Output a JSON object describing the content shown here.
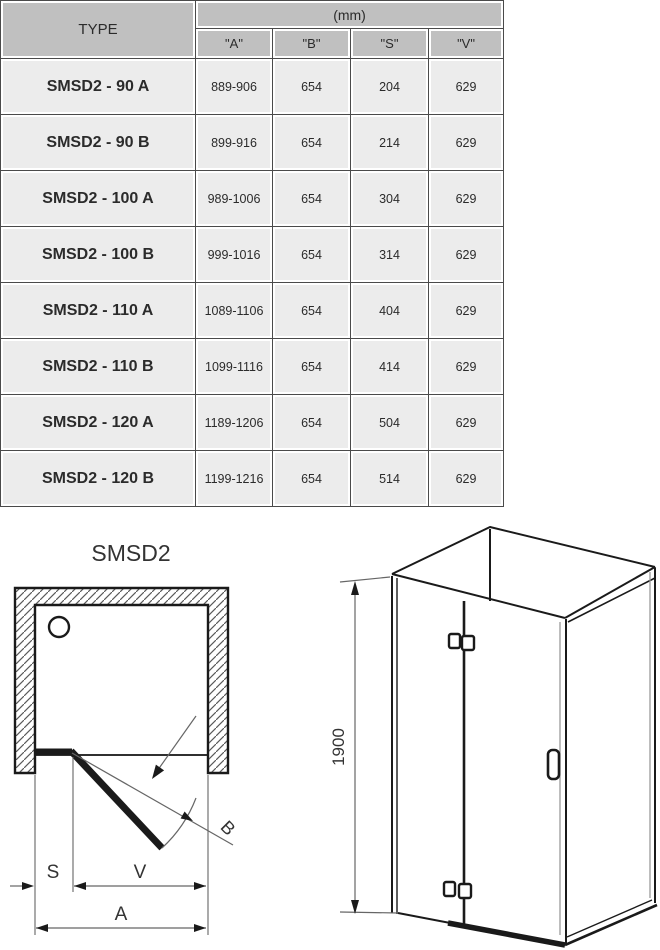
{
  "table": {
    "type_header": "TYPE",
    "unit_header": "(mm)",
    "columns": [
      "\"A\"",
      "\"B\"",
      "\"S\"",
      "\"V\""
    ],
    "rows": [
      {
        "type": "SMSD2 - 90 A",
        "a": "889-906",
        "b": "654",
        "s": "204",
        "v": "629"
      },
      {
        "type": "SMSD2 - 90 B",
        "a": "899-916",
        "b": "654",
        "s": "214",
        "v": "629"
      },
      {
        "type": "SMSD2 - 100 A",
        "a": "989-1006",
        "b": "654",
        "s": "304",
        "v": "629"
      },
      {
        "type": "SMSD2 - 100 B",
        "a": "999-1016",
        "b": "654",
        "s": "314",
        "v": "629"
      },
      {
        "type": "SMSD2 - 110 A",
        "a": "1089-1106",
        "b": "654",
        "s": "404",
        "v": "629"
      },
      {
        "type": "SMSD2 - 110 B",
        "a": "1099-1116",
        "b": "654",
        "s": "414",
        "v": "629"
      },
      {
        "type": "SMSD2 - 120 A",
        "a": "1189-1206",
        "b": "654",
        "s": "504",
        "v": "629"
      },
      {
        "type": "SMSD2 - 120 B",
        "a": "1199-1216",
        "b": "654",
        "s": "514",
        "v": "629"
      }
    ]
  },
  "diagrams": {
    "plan": {
      "title": "SMSD2",
      "dim_s": "S",
      "dim_v": "V",
      "dim_a": "A",
      "dim_b": "B"
    },
    "iso": {
      "height_label": "1900"
    }
  },
  "colors": {
    "header_bg": "#c0c0c0",
    "cell_bg": "#ececec",
    "grid_line": "#4a4a4a",
    "drawing_line": "#1a1a1a",
    "dimension_line": "#666666",
    "page_bg": "#ffffff"
  }
}
